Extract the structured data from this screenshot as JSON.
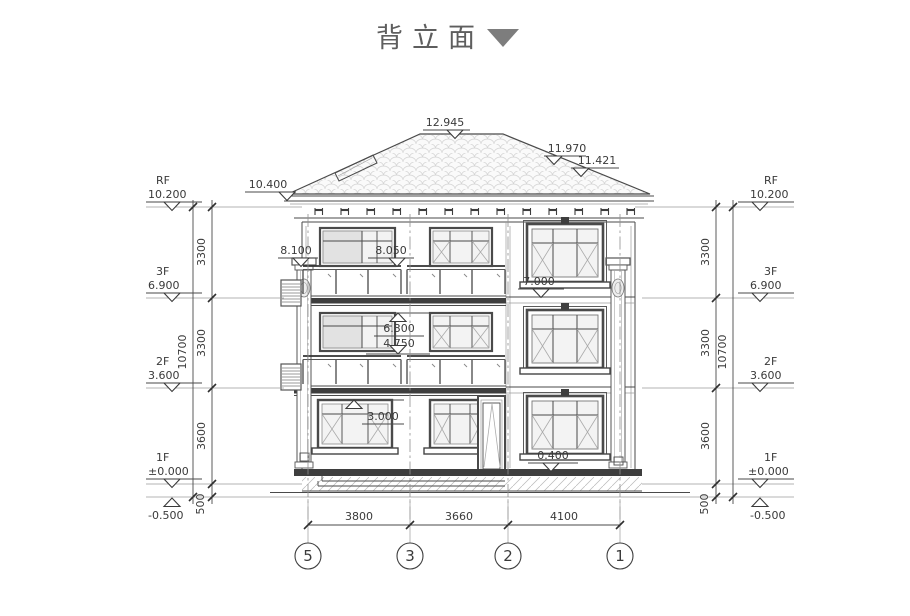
{
  "title": {
    "text": "背立面"
  },
  "levels_left": [
    {
      "name": "RF",
      "value": "10.200"
    },
    {
      "name": "3F",
      "value": "6.900"
    },
    {
      "name": "2F",
      "value": "3.600"
    },
    {
      "name": "1F",
      "value": "±0.000"
    },
    {
      "name": "",
      "value": "-0.500"
    }
  ],
  "levels_right": [
    {
      "name": "RF",
      "value": "10.200"
    },
    {
      "name": "3F",
      "value": "6.900"
    },
    {
      "name": "2F",
      "value": "3.600"
    },
    {
      "name": "1F",
      "value": "±0.000"
    },
    {
      "name": "",
      "value": "-0.500"
    }
  ],
  "dims": {
    "left": {
      "total": "10700",
      "segments": [
        "3300",
        "3300",
        "3600",
        "500"
      ]
    },
    "right": {
      "total": "10700",
      "segments": [
        "3300",
        "3300",
        "3600",
        "500"
      ]
    },
    "bottom": [
      "3800",
      "3660",
      "4100"
    ]
  },
  "spots": {
    "ridge": "12.945",
    "slope_upper": "11.970",
    "slope_lower": "11.421",
    "eave": "10.400",
    "balcony3_end": "8.100",
    "balcony3_rail": "8.050",
    "window3_sill": "7.000",
    "window2_head": "6.300",
    "balcony2_rail": "4.750",
    "window1_head": "3.000",
    "window1_sill": "0.400"
  },
  "axes": [
    "5",
    "3",
    "2",
    "1"
  ],
  "colors": {
    "line": "#3f3f3f",
    "title_gray": "#5e5e5e",
    "marker_triangle": "#7d7d7d",
    "tile": "#d4d4d4"
  }
}
